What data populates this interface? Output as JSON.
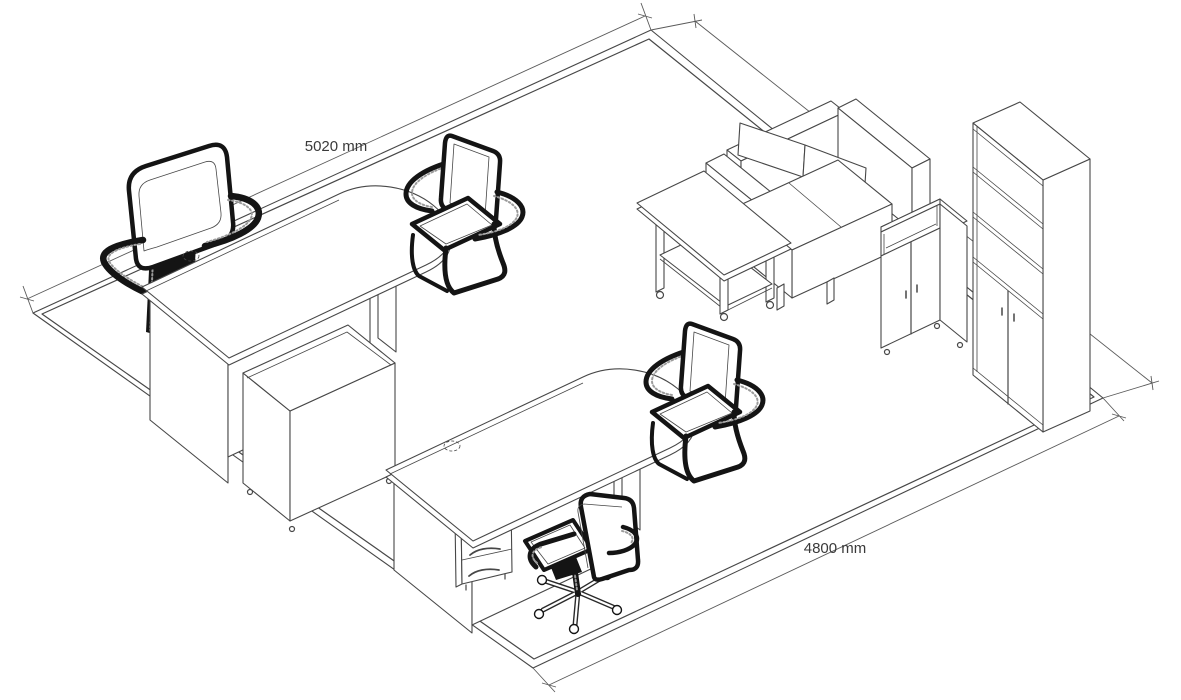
{
  "drawing": {
    "type": "isometric-office-furniture-layout",
    "dimensions": {
      "width_label": "5020 mm",
      "depth_label": "4800 mm"
    },
    "colors": {
      "background": "#ffffff",
      "furniture_line": "#474747",
      "dimension_line": "#5a5a5a",
      "chair_outline": "#141414",
      "label_text": "#3a3a3a"
    },
    "furniture": [
      "desk with rounded end (x2)",
      "high-back executive chair",
      "cantilever visitor chair (x2)",
      "swivel task chair on casters",
      "mobile storage pedestal",
      "3-drawer desk pedestal",
      "two-seat sofa",
      "coffee table with lower shelf",
      "low two-door cabinet",
      "tall bookcase with two-door base"
    ]
  }
}
